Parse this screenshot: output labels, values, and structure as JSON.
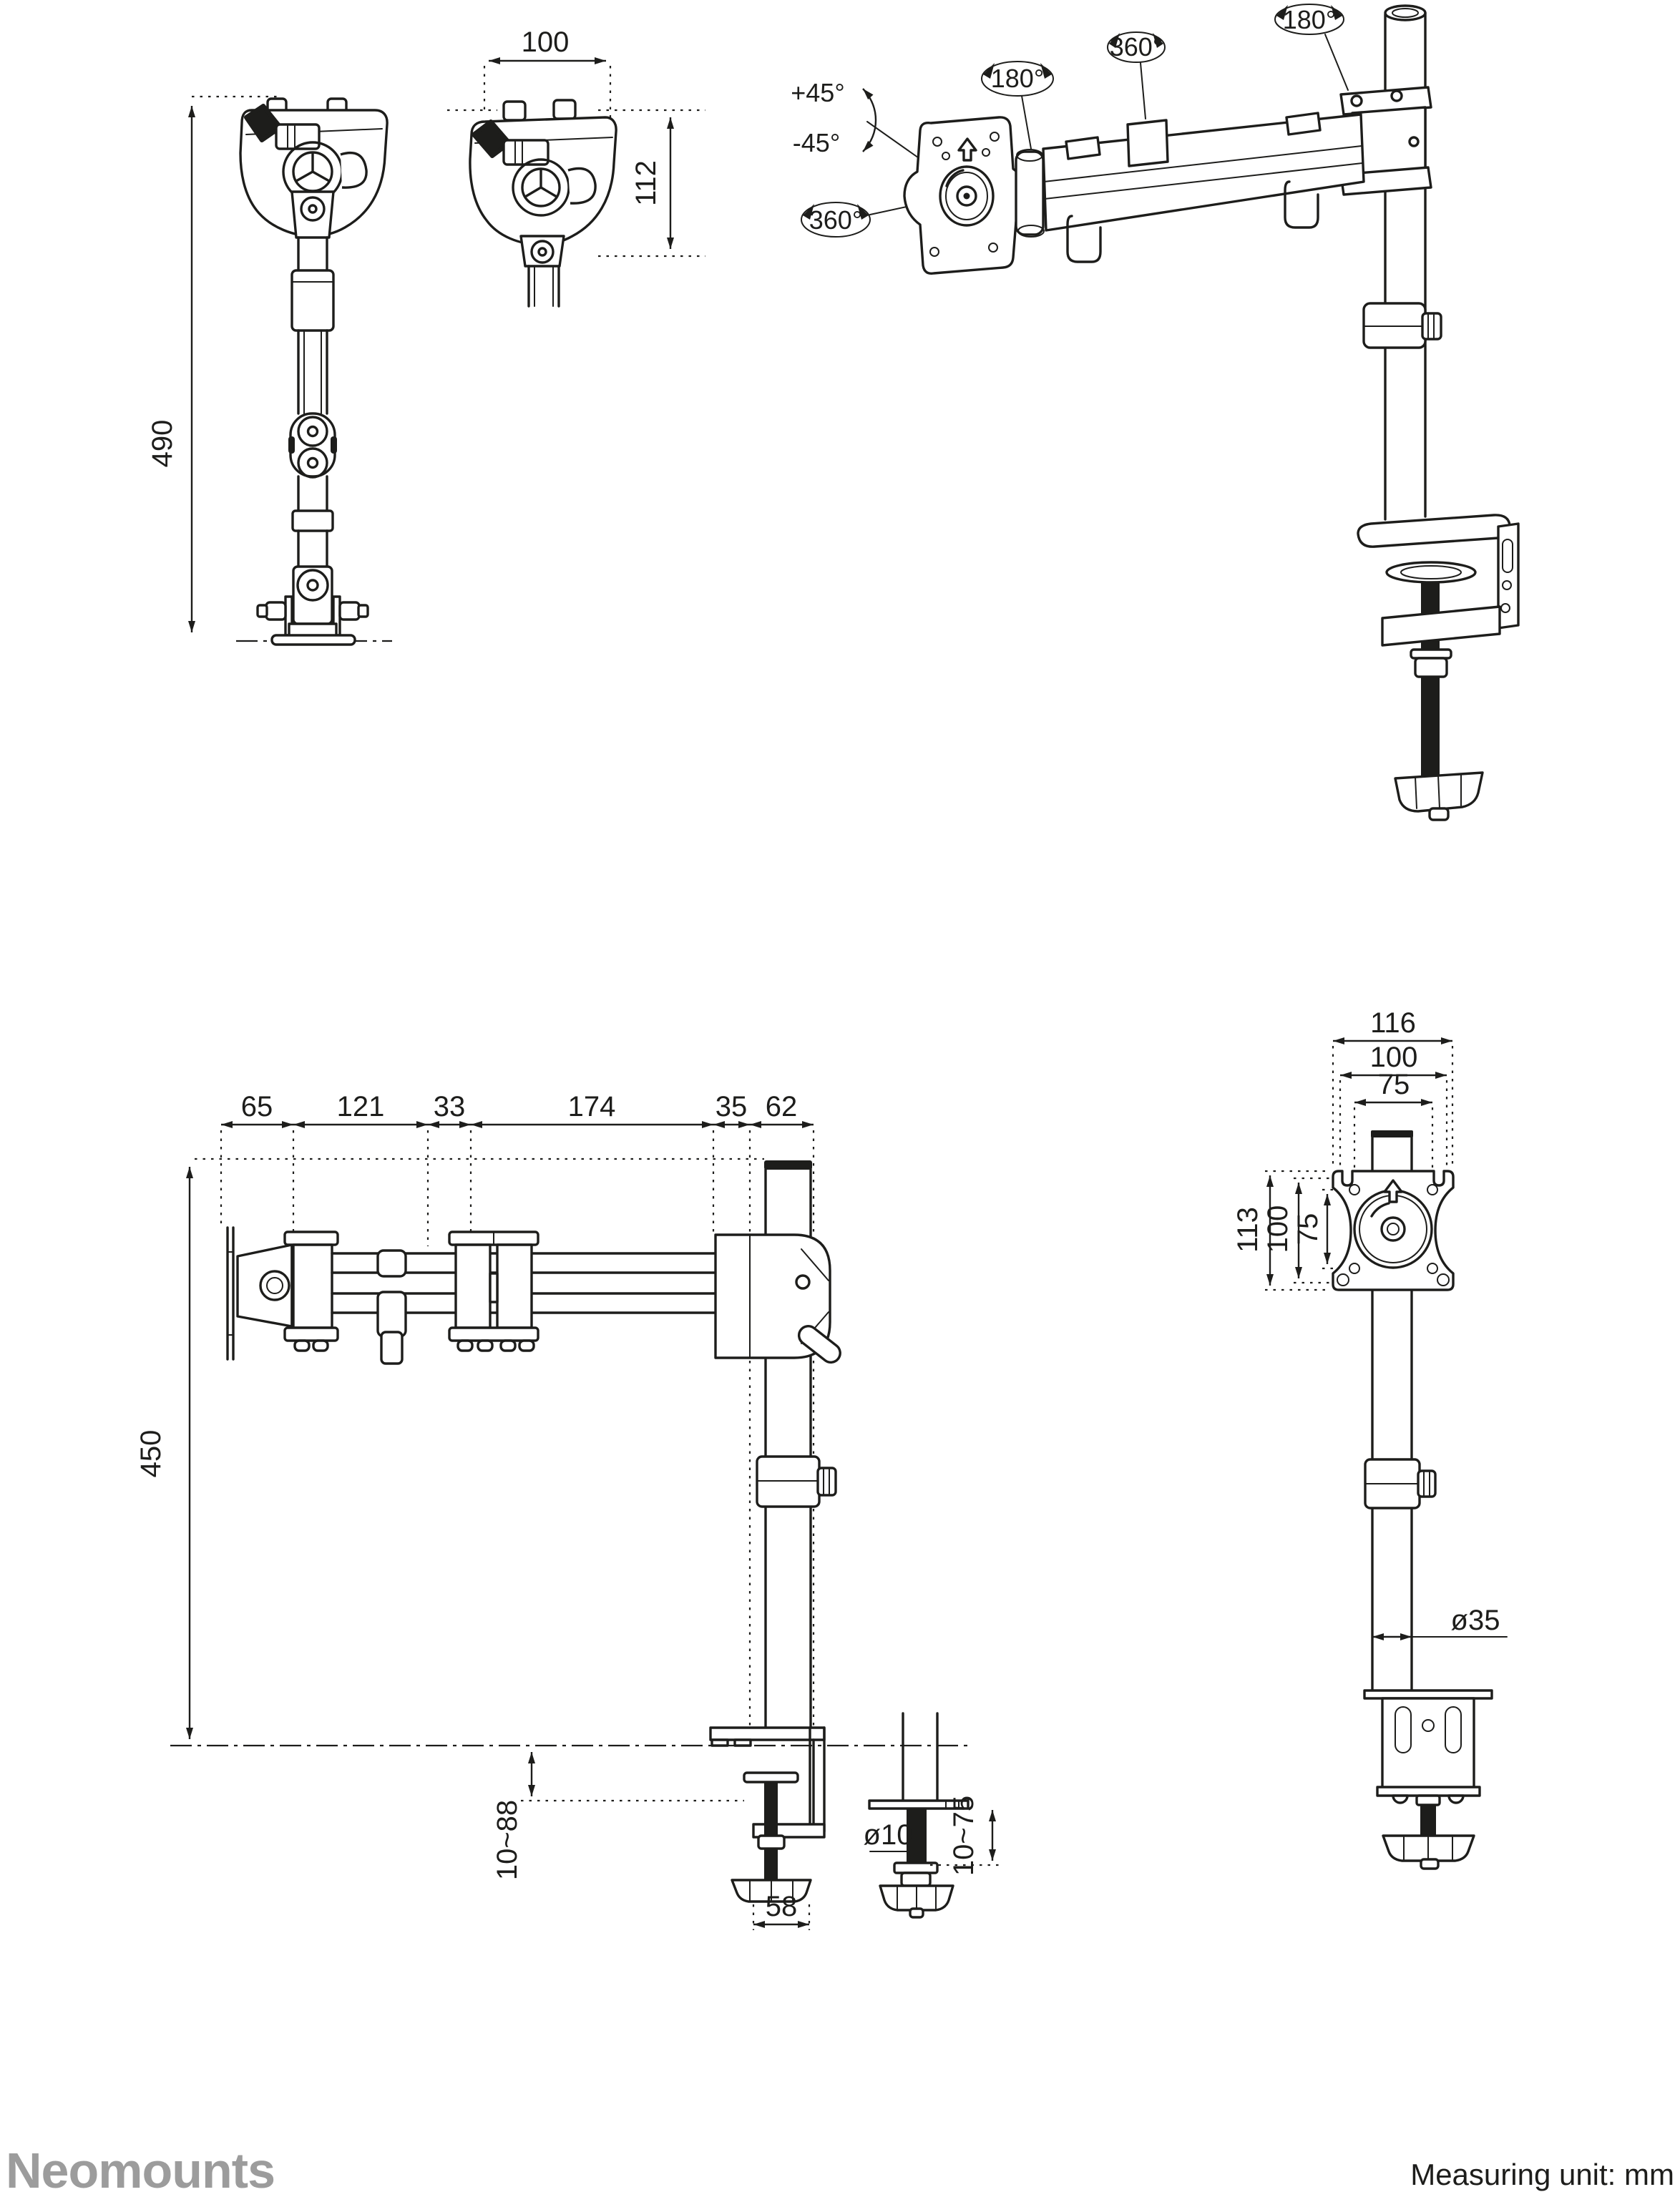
{
  "page": {
    "background": "#ffffff",
    "line_color": "#1d1d1b",
    "logo_color": "#9c9c9c"
  },
  "brand_logo": "Neomounts",
  "measuring_unit": "Measuring unit: mm",
  "rear_view": {
    "total_height": "490"
  },
  "head_view": {
    "width": "100",
    "height": "112"
  },
  "perspective_view": {
    "tilt_up": "+45°",
    "tilt_down": "-45°",
    "vesa_spin": "360°",
    "head_swivel": "180°",
    "arm_swivel": "360°",
    "pole_swivel": "180°"
  },
  "side_view": {
    "vesa_offset": "65",
    "front_arm": "121",
    "mid_joint": "33",
    "rear_arm": "174",
    "pole_offset": "35",
    "clamp_depth": "62",
    "pole_height": "450",
    "desk_thickness": "10~88",
    "clamp_width": "58"
  },
  "grommet_view": {
    "bolt_diameter": "ø10",
    "desk_thickness": "10~75"
  },
  "front_view": {
    "plate_width": "116",
    "hole_width": "100",
    "hole_width_inner": "75",
    "plate_height": "113",
    "hole_height": "100",
    "hole_height_inner": "75",
    "pole_diameter": "ø35"
  }
}
